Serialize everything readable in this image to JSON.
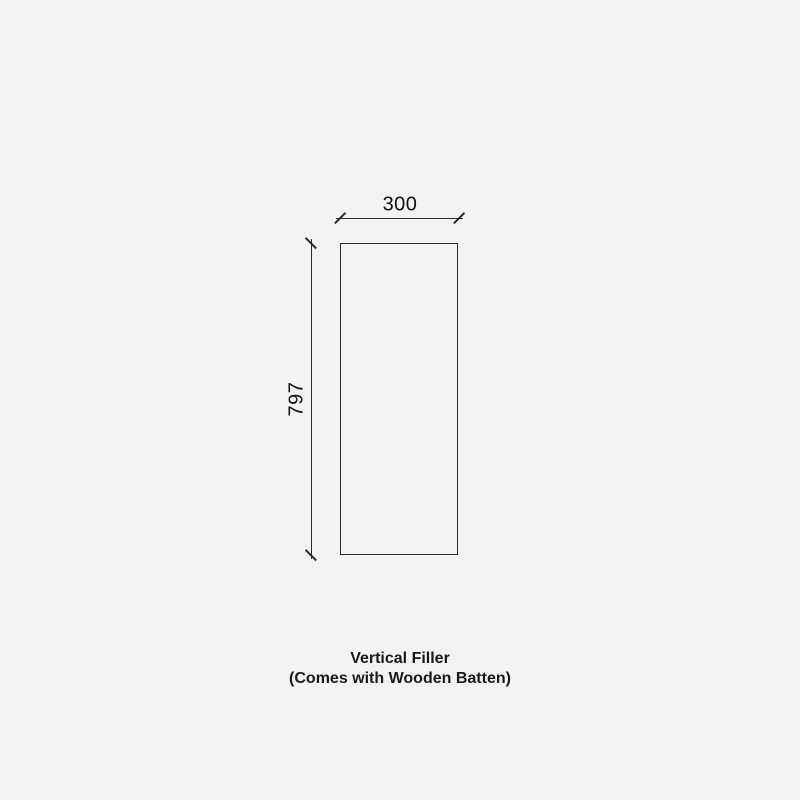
{
  "page": {
    "background_color": "#f2f2f2",
    "line_color": "#2a2a2a",
    "text_color": "#1a1a1a"
  },
  "diagram": {
    "type": "technical-drawing",
    "part": {
      "name": "Vertical Filler",
      "width_mm": 300,
      "height_mm": 797
    },
    "dimensions": {
      "width_label": "300",
      "height_label": "797"
    },
    "caption": {
      "line1": "Vertical Filler",
      "line2": "(Comes with Wooden Batten)"
    }
  }
}
